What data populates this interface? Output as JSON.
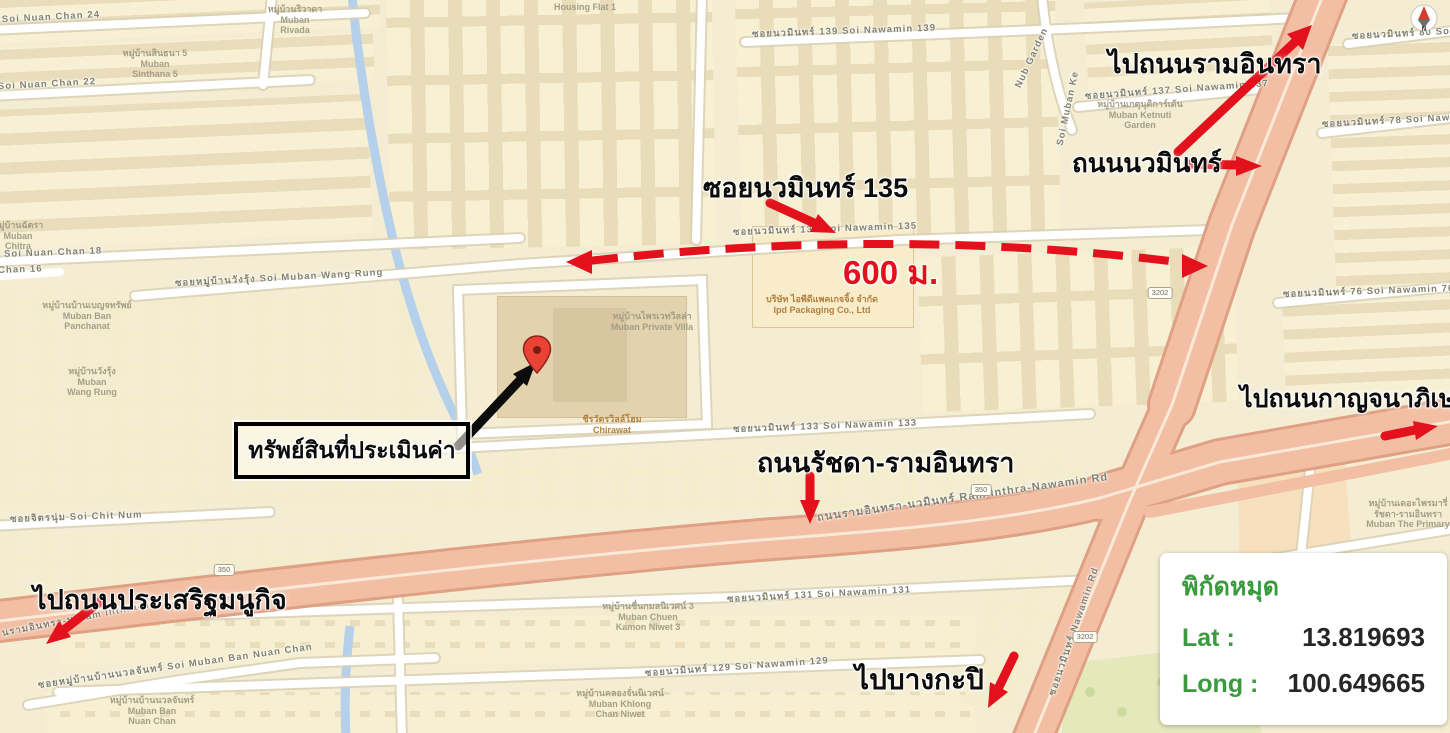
{
  "annotations": {
    "to_ram_inthra": "ไปถนนรามอินทรา",
    "nawamin_road": "ถนนนวมินทร์",
    "soi_nawamin_135": "ซอยนวมินทร์ 135",
    "distance": "600 ม.",
    "property": "ทรัพย์สินที่ประเมินค่า",
    "ratchada_ram_inthra": "ถนนรัชดา-รามอินทรา",
    "to_kanchanaphisek": "ไปถนนกาญจนาภิเษก",
    "to_prasert_manukit": "ไปถนนประเสริฐมนูกิจ",
    "to_bang_kapi": "ไปบางกะปิ"
  },
  "coords_panel": {
    "title": "พิกัดหมุด",
    "lat_label": "Lat :",
    "lat_value": "13.819693",
    "long_label": "Long :",
    "long_value": "100.649665"
  },
  "compass": {
    "letter": "N"
  },
  "colors": {
    "annotation_red": "#e2111c",
    "panel_green": "#3a9a3e",
    "major_road": "#f3bfa4",
    "map_base": "#f4edd3",
    "stream_blue": "#b5d0ea"
  },
  "map": {
    "shields": [
      {
        "text": "350",
        "x": 981,
        "y": 484
      },
      {
        "text": "350",
        "x": 224,
        "y": 564
      },
      {
        "text": "3202",
        "x": 1160,
        "y": 287
      },
      {
        "text": "3202",
        "x": 1085,
        "y": 631
      }
    ],
    "labels": [
      {
        "name": "road-soi-nuan-chan-24",
        "cls": "road",
        "th": "ซอยนวลจันทร์ 24",
        "en": "Soi Nuan Chan 24",
        "x": -88,
        "y": 17,
        "r": -3
      },
      {
        "name": "road-soi-nuan-chan-22",
        "cls": "road",
        "th": "ซอยนวลจันทร์ 22",
        "en": "Soi Nuan Chan 22",
        "x": -92,
        "y": 84,
        "r": -3
      },
      {
        "name": "road-soi-nuan-chan-18",
        "cls": "road",
        "th": "ซอยนวลจันทร์ 18",
        "en": "Soi Nuan Chan 18",
        "x": -86,
        "y": 250,
        "r": -2
      },
      {
        "name": "road-chan-16",
        "cls": "road",
        "en": "Chan 16",
        "x": -2,
        "y": 265,
        "r": -2
      },
      {
        "name": "road-soi-muban-wang-rung",
        "cls": "road",
        "th": "ซอยหมู่บ้านวังรุ้ง",
        "en": "Soi Muban Wang Rung",
        "x": 175,
        "y": 276,
        "r": -3
      },
      {
        "name": "road-soi-nawamin-139",
        "cls": "road",
        "th": "ซอยนวมินทร์ 139",
        "en": "Soi Nawamin 139",
        "x": 752,
        "y": 27,
        "r": -2
      },
      {
        "name": "road-soi-nawamin-137",
        "cls": "road",
        "th": "ซอยนวมินทร์ 137",
        "en": "Soi Nawamin 137",
        "x": 1085,
        "y": 89,
        "r": -4
      },
      {
        "name": "road-soi-nawamin-80",
        "cls": "road",
        "th": "ซอยนวมินทร์ 80",
        "en": "Soi Nawamin 80",
        "x": 1352,
        "y": 29,
        "r": -3
      },
      {
        "name": "road-soi-nawamin-78",
        "cls": "road",
        "th": "ซอยนวมินทร์ 78",
        "en": "Soi Nawamin 78",
        "x": 1322,
        "y": 117,
        "r": -3
      },
      {
        "name": "road-soi-nawamin-76",
        "cls": "road",
        "th": "ซอยนวมินทร์ 76",
        "en": "Soi Nawamin 76",
        "x": 1283,
        "y": 287,
        "r": -2
      },
      {
        "name": "road-soi-nawamin-135",
        "cls": "road",
        "th": "ซอยนวมินทร์ 135",
        "en": "Soi Nawamin 135",
        "x": 733,
        "y": 225,
        "r": -2
      },
      {
        "name": "road-soi-nawamin-133",
        "cls": "road",
        "th": "ซอยนวมินทร์ 133",
        "en": "Soi Nawamin 133",
        "x": 733,
        "y": 422,
        "r": -2
      },
      {
        "name": "road-soi-chit-num",
        "cls": "road",
        "th": "ซอยจิตรนุ่ม",
        "en": "Soi Chit Num",
        "x": 10,
        "y": 512,
        "r": -2
      },
      {
        "name": "road-ram-inthra-nawamin",
        "cls": "road",
        "size": 11,
        "th": "ถนนรามอินทรา-นวมินทร์",
        "en": "Ram Inthra-Nawamin Rd",
        "x": 817,
        "y": 508,
        "r": -8
      },
      {
        "name": "road-ram-inthra-partial",
        "cls": "road",
        "th": "นรามอินทรา-น",
        "en": "Ram Inthra-N",
        "x": 2,
        "y": 626,
        "r": -11
      },
      {
        "name": "road-soi-nawamin-131",
        "cls": "road",
        "th": "ซอยนวมินทร์ 131",
        "en": "Soi Nawamin 131",
        "x": 727,
        "y": 592,
        "r": -3
      },
      {
        "name": "road-soi-nawamin-129",
        "cls": "road",
        "th": "ซอยนวมินทร์ 129",
        "en": "Soi Nawamin 129",
        "x": 645,
        "y": 666,
        "r": -4
      },
      {
        "name": "road-soi-muban-ban-nuan-chan",
        "cls": "road",
        "th": "ซอยหมู่บ้านบ้านนวลจันทร์",
        "en": "Soi Muban Ban Nuan Chan",
        "x": 38,
        "y": 678,
        "r": -8
      },
      {
        "name": "road-nawamin-vertical",
        "cls": "road",
        "th": "ซอยนวมินทร์",
        "en": "Nawamin Rd",
        "x": 1052,
        "y": 688,
        "r": -71
      },
      {
        "name": "road-muban-ke",
        "cls": "road",
        "en": "Soi Muban Ke",
        "x": 1060,
        "y": 140,
        "r": -78
      },
      {
        "name": "road-nub-garden",
        "cls": "road",
        "en": "Nub Garden",
        "x": 1018,
        "y": 82,
        "r": -65
      },
      {
        "name": "place-housing-flat-1",
        "cls": "place",
        "lines": [
          "Housing Flat 1"
        ],
        "x": 585,
        "y": 2,
        "center": true
      },
      {
        "name": "place-muban-rivada",
        "cls": "place",
        "lines": [
          "หมู่บ้านริวาดา",
          "Muban",
          "Rivada"
        ],
        "x": 295,
        "y": 4,
        "center": true
      },
      {
        "name": "place-muban-sinthana-5",
        "cls": "place",
        "lines": [
          "หมู่บ้านสินธนา 5",
          "Muban",
          "Sinthana 5"
        ],
        "x": 155,
        "y": 48,
        "center": true
      },
      {
        "name": "place-muban-chitra",
        "cls": "place",
        "lines": [
          "หมู่บ้านฉัตรา",
          "Muban",
          "Chitra"
        ],
        "x": 18,
        "y": 220,
        "center": true
      },
      {
        "name": "place-muban-ban-panchanat",
        "cls": "place",
        "lines": [
          "หมู่บ้านบ้านเบญจทรัพย์",
          "Muban Ban",
          "Panchanat"
        ],
        "x": 87,
        "y": 300,
        "center": true
      },
      {
        "name": "place-muban-wang-rung",
        "cls": "place",
        "lines": [
          "หมู่บ้านวังรุ้ง",
          "Muban",
          "Wang Rung"
        ],
        "x": 92,
        "y": 366,
        "center": true
      },
      {
        "name": "place-muban-private-villa",
        "cls": "place",
        "lines": [
          "หมู่บ้านไพรเวทวิลล่า",
          "Muban Private Villa"
        ],
        "x": 652,
        "y": 311,
        "center": true
      },
      {
        "name": "place-ipd-packaging",
        "cls": "place",
        "color": "#b3813f",
        "lines": [
          "บริษัท ไอพีดีแพคเกจจิ้ง จำกัด",
          "Ipd Packaging Co., Ltd"
        ],
        "x": 822,
        "y": 294,
        "center": true
      },
      {
        "name": "place-chirawat",
        "cls": "place",
        "color": "#b3813f",
        "lines": [
          "ชีรวัตรวิลล์โฮม",
          "Chirawat"
        ],
        "x": 612,
        "y": 414,
        "center": true
      },
      {
        "name": "place-muban-ketnuti-garden",
        "cls": "place",
        "lines": [
          "หมู่บ้านเกตุนุติการ์เด้น",
          "Muban Ketnuti",
          "Garden"
        ],
        "x": 1140,
        "y": 99,
        "center": true
      },
      {
        "name": "place-muban-chuen-kamon-niwet",
        "cls": "place",
        "lines": [
          "หมู่บ้านชื่นกมลนิเวศน์ 3",
          "Muban Chuen",
          "Kamon Niwet 3"
        ],
        "x": 648,
        "y": 601,
        "center": true
      },
      {
        "name": "place-muban-khlong-chan-niwet",
        "cls": "place",
        "lines": [
          "หมู่บ้านคลองจั่นนิเวศน์",
          "Muban Khlong",
          "Chan Niwet"
        ],
        "x": 620,
        "y": 688,
        "center": true
      },
      {
        "name": "place-muban-ban-nuan-chan",
        "cls": "place",
        "lines": [
          "หมู่บ้านบ้านนวลจันทร์",
          "Muban Ban",
          "Nuan Chan"
        ],
        "x": 152,
        "y": 695,
        "center": true
      },
      {
        "name": "place-muban-the-primary",
        "cls": "place",
        "lines": [
          "หมู่บ้านเดอะไพรมารี่",
          "รัชดา-รามอินทรา",
          "Muban The Primary"
        ],
        "x": 1408,
        "y": 498,
        "center": true
      }
    ]
  }
}
